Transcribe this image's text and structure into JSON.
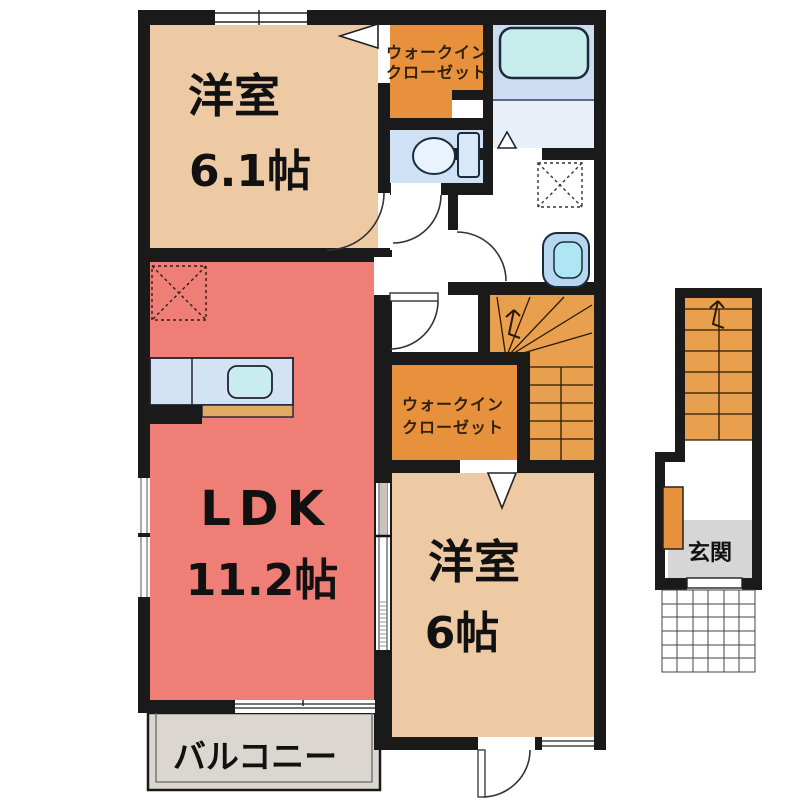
{
  "plan": {
    "type": "floor-plan",
    "floor": "2F apartment unit",
    "rooms": {
      "bedroom1": {
        "name": "洋室",
        "size": "6.1帖"
      },
      "ldk": {
        "name": "LDK",
        "size": "11.2帖"
      },
      "bedroom2": {
        "name": "洋室",
        "size": "6帖"
      },
      "wic1": {
        "line1": "ウォークイン",
        "line2": "クローゼット"
      },
      "wic2": {
        "line1": "ウォークイン",
        "line2": "クローゼット"
      },
      "balcony": {
        "name": "バルコニー"
      },
      "entrance": {
        "name": "玄関"
      }
    }
  },
  "colors": {
    "wall": "#1a1a1a",
    "bedroom": "#eecaa4",
    "ldk": "#ef7e76",
    "closet": "#e8913c",
    "stairs": "#e9a04e",
    "toilet_room": "#cfe1f5",
    "bath_upper": "#ccdcf1",
    "bath_lower": "#e9eff9",
    "bathtub": "#c8eded",
    "balcony": "#dbd7d0",
    "genkan": "#d6d6d6",
    "counter": "#d2e3f4",
    "sink": "#c9ecf0",
    "counter_bar": "#e3aa66",
    "basin_outer": "#b7d7f0",
    "basin_bowl": "#aee6f4",
    "shoebox": "#e8913c"
  }
}
